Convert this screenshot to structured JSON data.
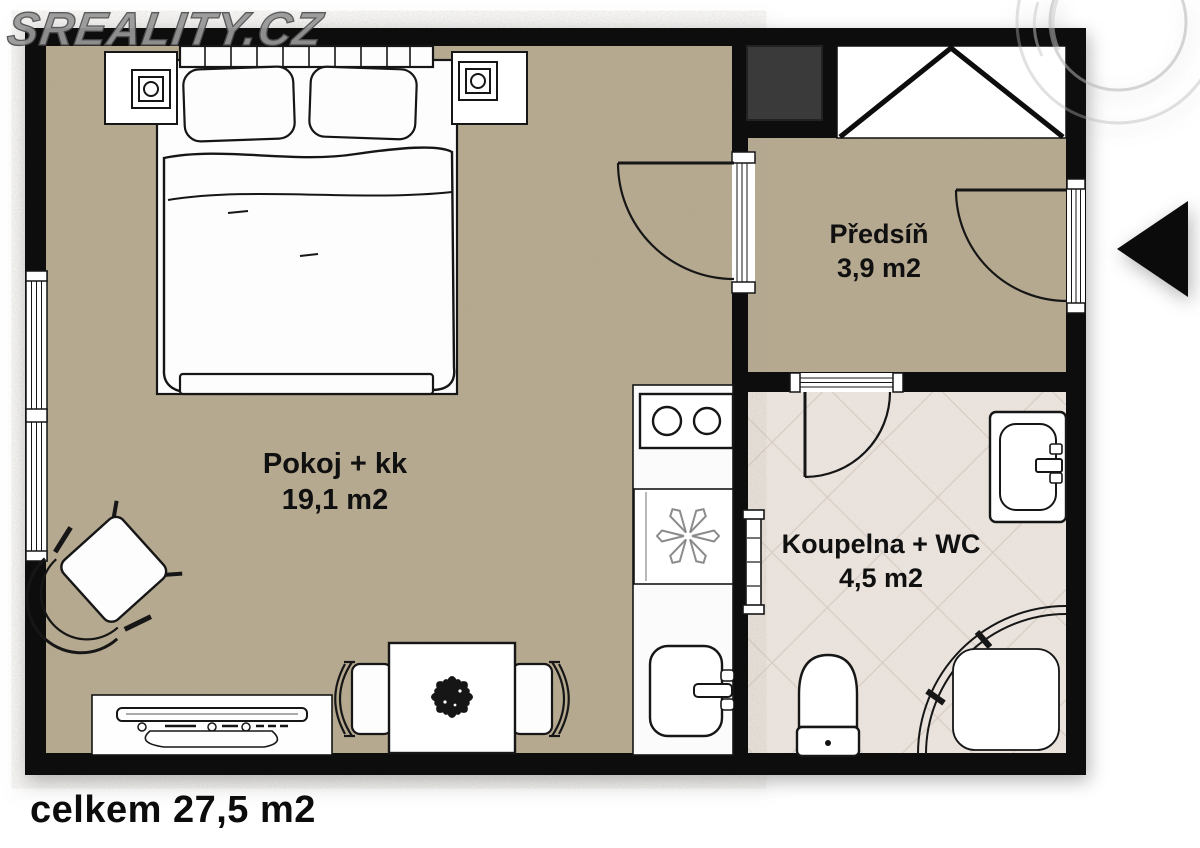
{
  "watermark": {
    "text": "SREALITY.CZ"
  },
  "rooms": [
    {
      "name": "Pokoj + kk",
      "area": "19,1 m2"
    },
    {
      "name": "Předsíň",
      "area": "3,9 m2"
    },
    {
      "name": "Koupelna + WC",
      "area": "4,5 m2"
    }
  ],
  "total_area_label": "celkem 27,5 m2",
  "entrance": {
    "arrow_direction": "left"
  },
  "colors": {
    "wall": "#0d0d0d",
    "room_floor": "#b6a98f",
    "bathroom_tile": "#ece5df",
    "bathroom_tile_line": "#d8cec6",
    "watermark": "#979797",
    "shaft": "#3a3a3a",
    "arrow": "#0b0b0b"
  },
  "furniture": [
    "double-bed",
    "headboard",
    "pillows",
    "nightstand-left",
    "nightstand-right",
    "table-lamp-left",
    "table-lamp-right",
    "armchair",
    "tv-sideboard",
    "dining-table",
    "dining-chair-left",
    "dining-chair-right",
    "plant-centerpiece",
    "kitchen-counter",
    "cooktop",
    "refrigerator",
    "kitchen-sink",
    "built-in-wardrobe",
    "utility-shaft",
    "washbasin",
    "toilet",
    "corner-shower",
    "towel-radiator",
    "window",
    "entry-door",
    "room-door",
    "bathroom-door"
  ]
}
